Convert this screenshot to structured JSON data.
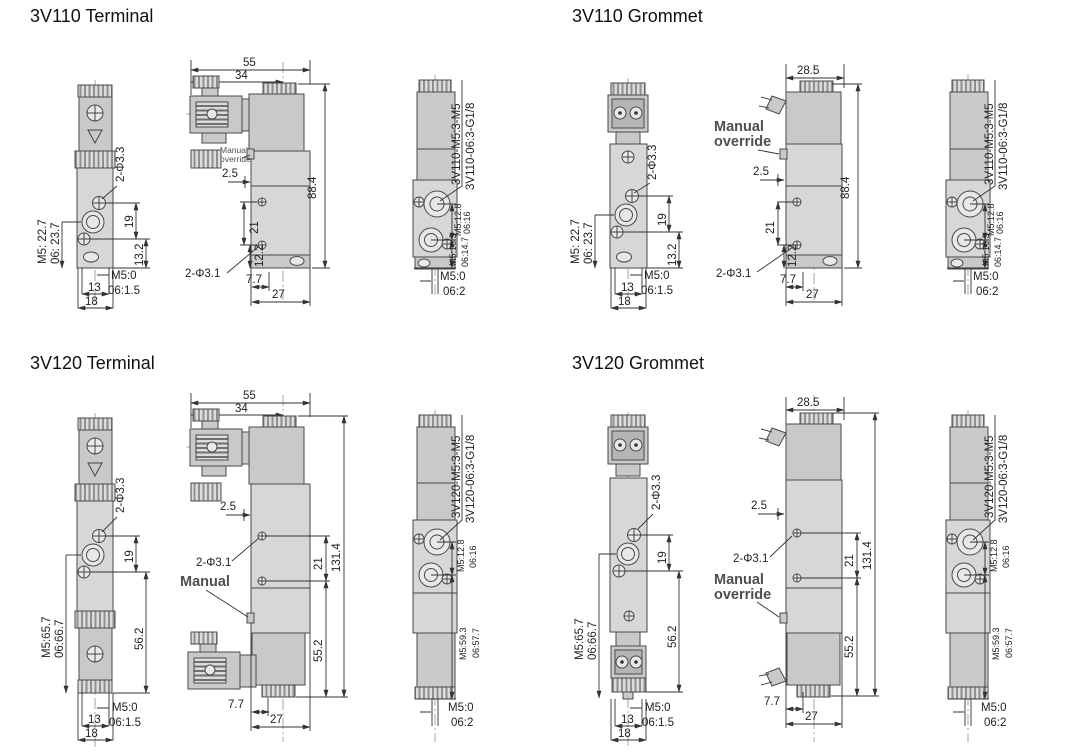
{
  "sections": {
    "tl": {
      "title": "3V110 Terminal",
      "front": {
        "holes": "2-Φ3.3",
        "side_m5": "M5: 22.7",
        "side_06": "06: 23.7",
        "h1": "19",
        "h2": "13.2",
        "base_m5": "M5:0",
        "base_06": "06:1.5",
        "w1": "13",
        "w2": "18"
      },
      "side": {
        "w1": "55",
        "w2": "34",
        "ov1": "Manual",
        "ov2": "override",
        "offset": "2.5",
        "height": "88.4",
        "sp1": "21",
        "sp2": "12.2",
        "holes": "2-Φ3.1",
        "b1": "7.7",
        "b2": "27"
      },
      "end": {
        "m1": "3V110-M5:3-M5",
        "m2": "3V110-06:3-G1/8",
        "p1a": "M5:12.8",
        "p1b": "06:16",
        "p2a": "M5:16.3",
        "p2b": "06:14.7",
        "base_m5": "M5:0",
        "base_06": "06:2"
      }
    },
    "tr": {
      "title": "3V110 Grommet",
      "front": {
        "holes": "2-Φ3.3",
        "side_m5": "M5: 22.7",
        "side_06": "06: 23.7",
        "h1": "19",
        "h2": "13.2",
        "base_m5": "M5:0",
        "base_06": "06:1.5",
        "w1": "13",
        "w2": "18"
      },
      "side": {
        "w1": "28.5",
        "ov1": "Manual",
        "ov2": "override",
        "offset": "2.5",
        "height": "88.4",
        "sp1": "21",
        "sp2": "12.2",
        "holes": "2-Φ3.1",
        "b1": "7.7",
        "b2": "27"
      },
      "end": {
        "m1": "3V110-M5:3-M5",
        "m2": "3V110-06:3-G1/8",
        "p1a": "M5:12.8",
        "p1b": "06:16",
        "p2a": "M5:16.3",
        "p2b": "06:14.7",
        "base_m5": "M5:0",
        "base_06": "06:2"
      }
    },
    "bl": {
      "title": "3V120 Terminal",
      "front": {
        "holes": "2-Φ3.3",
        "side_m5": "M5:65.7",
        "side_06": "06:66.7",
        "h1": "19",
        "h2": "56.2",
        "base_m5": "M5:0",
        "base_06": "06:1.5",
        "w1": "13",
        "w2": "18"
      },
      "side": {
        "w1": "55",
        "w2": "34",
        "ov1": "Manual",
        "offset": "2.5",
        "height": "131.4",
        "sp1": "21",
        "sp2": "55.2",
        "holes": "2-Φ3.1",
        "b1": "7.7",
        "b2": "27"
      },
      "end": {
        "m1": "3V120-M5:3-M5",
        "m2": "3V120-06:3-G1/8",
        "p1a": "M5:12.8",
        "p1b": "06:16",
        "p2a": "M5:59.3",
        "p2b": "06:57.7",
        "base_m5": "M5:0",
        "base_06": "06:2"
      }
    },
    "br": {
      "title": "3V120 Grommet",
      "front": {
        "holes": "2-Φ3.3",
        "side_m5": "M5:65.7",
        "side_06": "06:66.7",
        "h1": "19",
        "h2": "56.2",
        "base_m5": "M5:0",
        "base_06": "06:1.5",
        "w1": "13",
        "w2": "18"
      },
      "side": {
        "w1": "28.5",
        "ov1": "Manual",
        "ov2": "override",
        "offset": "2.5",
        "height": "131.4",
        "sp1": "21",
        "sp2": "55.2",
        "holes": "2-Φ3.1",
        "b1": "7.7",
        "b2": "27"
      },
      "end": {
        "m1": "3V120-M5:3-M5",
        "m2": "3V120-06:3-G1/8",
        "p1a": "M5:12.8",
        "p1b": "06:16",
        "p2a": "M5:59.3",
        "p2b": "06:57.7",
        "base_m5": "M5:0",
        "base_06": "06:2"
      }
    }
  }
}
